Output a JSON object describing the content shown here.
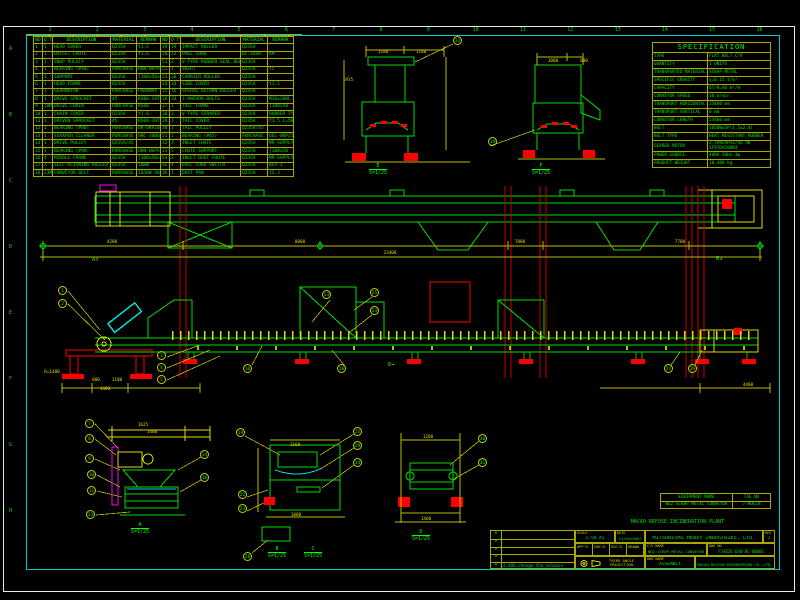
{
  "sheet": {
    "zone_numbers": [
      "1",
      "2",
      "3",
      "4",
      "5",
      "6",
      "7",
      "8",
      "9",
      "10",
      "11",
      "12",
      "13",
      "14",
      "15",
      "16"
    ],
    "zone_letters": [
      "A",
      "B",
      "C",
      "D",
      "E",
      "F",
      "G",
      "H"
    ]
  },
  "parts_list": {
    "headers": [
      "NO",
      "Q'TY",
      "DESCRIPTION",
      "MATERIAL",
      "REMARK"
    ],
    "rows_left": [
      [
        "1",
        "1",
        "HEAD COVER",
        "Q235A",
        "t1.5"
      ],
      [
        "2",
        "1",
        "OUTLET CHUTE",
        "Q235A",
        "t1.6"
      ],
      [
        "3",
        "1",
        "SNAP PULLEY",
        "Q235A",
        ""
      ],
      [
        "4",
        "1",
        "BEARING (#40)",
        "PURCHASE",
        "UKN-UKP408"
      ],
      [
        "5",
        "1",
        "SUPPORT",
        "Q235A",
        "[100x50x5"
      ],
      [
        "6",
        "1",
        "HEAD FRAME",
        "Q235A",
        ""
      ],
      [
        "7",
        "1",
        "GEARMOTOR",
        "PURCHASE",
        "PARAMAX"
      ],
      [
        "8",
        "1",
        "DRIVE SPROCKET",
        "45",
        "RS80-19T"
      ],
      [
        "9",
        "10M",
        "DRIVE CHAIN",
        "PURCHASE",
        "RS80"
      ],
      [
        "10",
        "1",
        "CHAIN COVER",
        "Q235A",
        "t1.6"
      ],
      [
        "11",
        "1",
        "DRIVEN SPROCKET",
        "45",
        "RS80-30T"
      ],
      [
        "12",
        "1",
        "BEARING (#80)",
        "PURCHASE",
        "UK-UKP208"
      ],
      [
        "13",
        "1",
        "SCRAPER CLEANER",
        "PURCHASE",
        "HNC-1000S"
      ],
      [
        "14",
        "1",
        "DRIVE PULLEY",
        "Q235A/45",
        ""
      ],
      [
        "15",
        "1",
        "BEARING (#90)",
        "PURCHASE",
        "UKN-UKP508"
      ],
      [
        "16",
        "4",
        "MIDDLE FRAME",
        "Q235A",
        "[100x50x5"
      ],
      [
        "17",
        "2",
        "SELF-ALIGNING ROLLER",
        "Q235A",
        "100W"
      ],
      [
        "18",
        "23M",
        "CONVEYOR BELT",
        "PURCHASE",
        "1050W 4800L"
      ]
    ],
    "rows_right": [
      [
        "19",
        "19",
        "IMPACT ROLLER",
        "Q235A",
        ""
      ],
      [
        "20",
        "22",
        "PULL CORD",
        "DC-1848",
        "4M"
      ],
      [
        "21",
        "2",
        "V-TYPE RUBBER SEAL BELT",
        "Q235A",
        ""
      ],
      [
        "22",
        "1",
        "SKIRT",
        "Q235A",
        "t5"
      ],
      [
        "23",
        "30",
        "CARRIER ROLLER",
        "Q235A",
        ""
      ],
      [
        "24",
        "34",
        "SIDE COVER",
        "Q235A",
        "t1.5"
      ],
      [
        "25",
        "16",
        "SPIRAL RETURN ROLLER",
        "Q235A",
        ""
      ],
      [
        "26",
        "34",
        "J-ANCHOR BOLTS",
        "Q235A",
        "M16x200L"
      ],
      [
        "27",
        "1",
        "TAIL FRAME",
        "Q235A",
        "[100x50"
      ],
      [
        "28",
        "1",
        "V-TYPE SCRAPER",
        "Q235A",
        "RUBBER TYPE"
      ],
      [
        "29",
        "1",
        "TAIL COVER",
        "Q235A",
        "t1.5 L=500"
      ],
      [
        "30",
        "1",
        "TAIL PULLEY",
        "Q235A/45",
        ""
      ],
      [
        "31",
        "2",
        "BEARING (#65)",
        "PURCHASE",
        "UEL-UKP213"
      ],
      [
        "32",
        "3",
        "INLET CHUTE",
        "Q235A",
        "MR SUPPLY"
      ],
      [
        "33",
        "5",
        "CHUTE SUPPORT",
        "Q235A",
        "[100x50"
      ],
      [
        "34",
        "3",
        "INLET DUST CHUTE",
        "Q235A",
        "MR SUPPLY"
      ],
      [
        "35",
        "4",
        "PULL CORD SWITCH",
        "Q235A",
        "BLP-3"
      ],
      [
        "36",
        "1",
        "DUST PAN",
        "Q235A",
        "t2.3"
      ]
    ]
  },
  "specification": {
    "title": "SPECIFICATION",
    "rows": [
      [
        "TYPE",
        "FLAT BELT C/V"
      ],
      [
        "QUANTITY",
        "1  UNITS"
      ],
      [
        "TRANSPORTED MATERIAL",
        "SCRAP METAL"
      ],
      [
        "SPECIFIC GRAVITY",
        "γ=0.15  t/m³"
      ],
      [
        "CAPACITY",
        "6T/H=40  m³/H"
      ],
      [
        "CONVEYOR SPEED",
        "10  m/min"
      ],
      [
        "TRANSPORT HORIZONTAL",
        "23400  mm"
      ],
      [
        "TRANSPORT VERTICAL",
        "0  mm"
      ],
      [
        "CONVEYOR LENGTH",
        "23400  mm"
      ],
      [
        "BELT",
        "1050Wx3P(1.5x2.4)"
      ],
      [
        "BELT TYPE",
        "HEAT RESISTANT RUBBER"
      ],
      [
        "GEARED MOTOR",
        "3.7kWx4Px1/43.98\nSF97DA100M4"
      ],
      [
        "POWER SOURCE",
        "400V 50Hz 3φ"
      ],
      [
        "PRODUCT WEIGHT",
        "10,400 kg"
      ]
    ]
  },
  "equipment_box": {
    "r1c1": "EQUIPMENT NAME",
    "r1c2": "TAG NO",
    "r2c1": "NO2 SCRAP METAL CONVEYOR",
    "r2c2": "7-HDE18"
  },
  "plant_title": "MACAO REFUSE INCINERATION PLANT",
  "title_block": {
    "scale_label": "SCALE",
    "scale": "1:50  A1",
    "date_label": "DATE",
    "date": "11/04/2007",
    "company": "MITSUBISHI HEAVY INDUSTRIES, LTD.",
    "rev_label": "REV",
    "rev": "1",
    "title_label": "C/V NAME",
    "drawing_title": "NO2 SCRAP METAL CONVEYOR",
    "dwgno_label": "DWG NO",
    "drawing_no": "FJ3626-D40-BC-00001",
    "item_label": "DWG NAME",
    "item": "ASSEMBLY",
    "projection": "THIRD ANGLE PROJECTION",
    "stamp": "MACAU DESIGN ENGINEERING CO.,LTD.",
    "signoff": [
      "APP'D",
      "CHK'D",
      "DSG'D",
      "DRAWN"
    ],
    "rev_rows": [
      "⊗",
      "⊗",
      "⊗",
      "⊗"
    ],
    "rev_note_sym": "Δ",
    "rev_note": "2.AUG   change the colours"
  },
  "balloons": [
    {
      "n": "1",
      "x": 63,
      "y": 291
    },
    {
      "n": "2",
      "x": 63,
      "y": 304
    },
    {
      "n": "3",
      "x": 162,
      "y": 356
    },
    {
      "n": "4",
      "x": 162,
      "y": 368
    },
    {
      "n": "5",
      "x": 162,
      "y": 380
    },
    {
      "n": "10",
      "x": 248,
      "y": 369
    },
    {
      "n": "16",
      "x": 342,
      "y": 369
    },
    {
      "n": "13",
      "x": 327,
      "y": 295
    },
    {
      "n": "25",
      "x": 375,
      "y": 293
    },
    {
      "n": "23",
      "x": 375,
      "y": 311
    },
    {
      "n": "27",
      "x": 669,
      "y": 369
    },
    {
      "n": "29",
      "x": 693,
      "y": 369
    },
    {
      "n": "32",
      "x": 458,
      "y": 41
    },
    {
      "n": "19",
      "x": 493,
      "y": 142
    },
    {
      "n": "7",
      "x": 90,
      "y": 424
    },
    {
      "n": "8",
      "x": 90,
      "y": 439
    },
    {
      "n": "9",
      "x": 90,
      "y": 459
    },
    {
      "n": "10",
      "x": 92,
      "y": 475
    },
    {
      "n": "11",
      "x": 92,
      "y": 491
    },
    {
      "n": "13",
      "x": 91,
      "y": 515
    },
    {
      "n": "14",
      "x": 205,
      "y": 455
    },
    {
      "n": "16",
      "x": 205,
      "y": 478
    },
    {
      "n": "19",
      "x": 241,
      "y": 433
    },
    {
      "n": "25",
      "x": 358,
      "y": 432
    },
    {
      "n": "29",
      "x": 358,
      "y": 446
    },
    {
      "n": "34",
      "x": 358,
      "y": 463
    },
    {
      "n": "22",
      "x": 243,
      "y": 495
    },
    {
      "n": "23",
      "x": 243,
      "y": 509
    },
    {
      "n": "28",
      "x": 248,
      "y": 557
    },
    {
      "n": "30",
      "x": 483,
      "y": 439
    },
    {
      "n": "31",
      "x": 483,
      "y": 463
    }
  ],
  "dims": [
    {
      "t": "4200",
      "x": 112,
      "y": 240
    },
    {
      "t": "8000",
      "x": 300,
      "y": 240
    },
    {
      "t": "7800",
      "x": 520,
      "y": 240
    },
    {
      "t": "7700",
      "x": 680,
      "y": 240
    },
    {
      "t": "23400",
      "x": 390,
      "y": 251
    },
    {
      "t": "1100",
      "x": 383,
      "y": 50
    },
    {
      "t": "1100",
      "x": 421,
      "y": 50
    },
    {
      "t": "1935",
      "x": 348,
      "y": 78
    },
    {
      "t": "1000",
      "x": 553,
      "y": 59
    },
    {
      "t": "800",
      "x": 584,
      "y": 59
    },
    {
      "t": "800",
      "x": 96,
      "y": 378
    },
    {
      "t": "1100",
      "x": 117,
      "y": 378
    },
    {
      "t": "1400",
      "x": 105,
      "y": 387
    },
    {
      "t": "4400",
      "x": 748,
      "y": 383
    },
    {
      "t": "R=1400",
      "x": 52,
      "y": 370
    },
    {
      "t": "1625",
      "x": 143,
      "y": 423
    },
    {
      "t": "1400",
      "x": 152,
      "y": 430
    },
    {
      "t": "1160",
      "x": 295,
      "y": 443
    },
    {
      "t": "1000",
      "x": 296,
      "y": 513
    },
    {
      "t": "1200",
      "x": 428,
      "y": 435
    },
    {
      "t": "1400",
      "x": 426,
      "y": 517
    }
  ],
  "view_labels": [
    {
      "l": "A",
      "s": "S=1/25",
      "x": 140,
      "y": 522
    },
    {
      "l": "B",
      "s": "S=1/25",
      "x": 277,
      "y": 546
    },
    {
      "l": "C",
      "s": "S=1/25",
      "x": 313,
      "y": 546
    },
    {
      "l": "D",
      "s": "S=1/25",
      "x": 421,
      "y": 529
    },
    {
      "l": "E",
      "s": "S=1/25",
      "x": 378,
      "y": 163
    },
    {
      "l": "F",
      "s": "S=1/25",
      "x": 541,
      "y": 163
    }
  ],
  "section_markers": [
    {
      "l": "E",
      "ar": "→",
      "x": 388,
      "y": 362
    },
    {
      "l": "B",
      "ar": "↓",
      "x": 716,
      "y": 256
    },
    {
      "l": "A",
      "ar": "↑",
      "x": 92,
      "y": 257
    }
  ]
}
